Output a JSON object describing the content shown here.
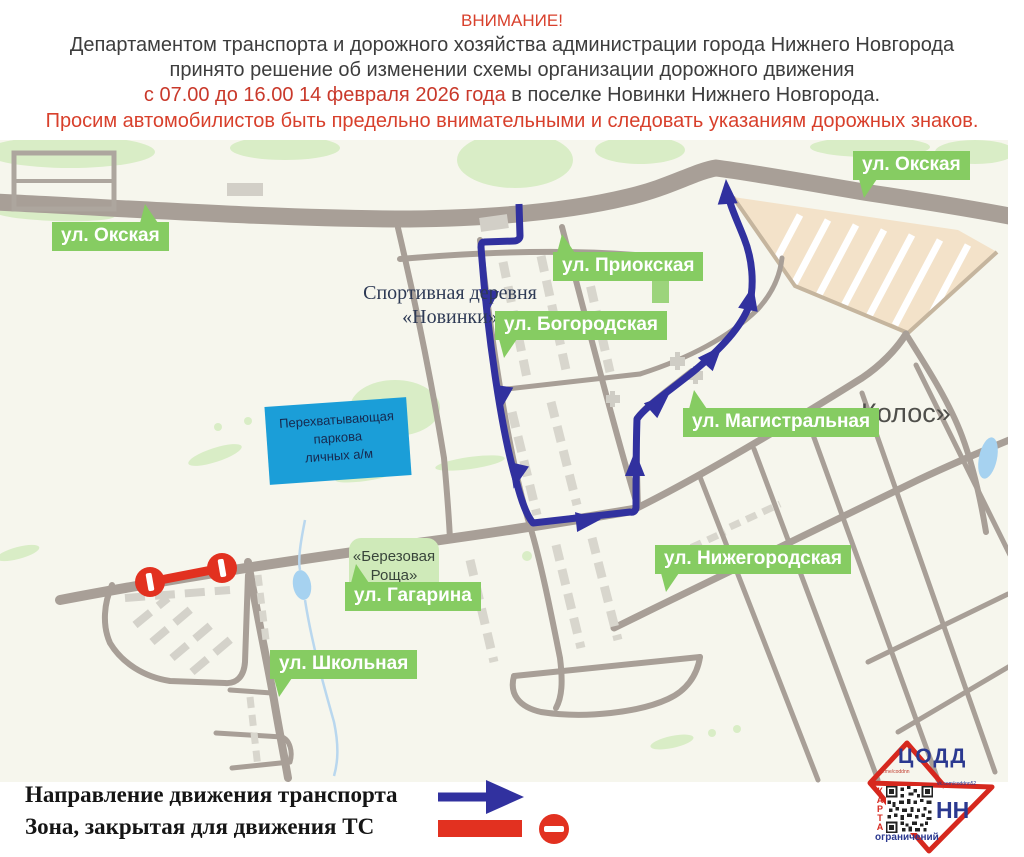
{
  "header": {
    "attention": "ВНИМАНИЕ!",
    "line1": "Департаментом транспорта и дорожного хозяйства администрации города Нижнего Новгорода",
    "line2": "принято решение об изменении схемы организации дорожного движения",
    "line3_red": "с 07.00 до 16.00 14 февраля 2026 года",
    "line3_dark": " в поселке Новинки Нижнего Новгорода.",
    "line4": "Просим автомобилистов быть предельно внимательными и следовать указаниям дорожных знаков."
  },
  "map": {
    "labels": {
      "okskaya_left": "ул. Окская",
      "okskaya_right": "ул. Окская",
      "priokskaya": "ул. Приокская",
      "bogorodskaya": "ул. Богородская",
      "magistralnaya": "ул. Магистральная",
      "nizhegorodskaya": "ул. Нижегородская",
      "gagarina": "ул. Гагарина",
      "shkolnaya": "ул. Школьная"
    },
    "places": {
      "sport_village_line1": "Спортивная деревня",
      "sport_village_line2": "«Новинки»",
      "kolos": "«Колос»",
      "birch_line1": "«Березовая",
      "birch_line2": "Роща»"
    },
    "parking": {
      "line1": "Перехватывающая",
      "line2": "паркова",
      "line3": "личных а/м"
    }
  },
  "legend": {
    "direction_label": "Направление движения транспорта",
    "closed_zone_label": "Зона, закрытая для движения ТС",
    "icons": {
      "direction": "blue-route-arrow",
      "closed_zone": "red-bar-with-no-entry-sign"
    }
  },
  "logo": {
    "org": "ЦОДД",
    "city": "НН",
    "vertical_word": "КАРТА",
    "caption": "ограничений",
    "tg": "t.me/coddnn",
    "vk": "vk.com/coddnn52"
  },
  "colors": {
    "route_blue": "#31319f",
    "closure_red": "#e23120",
    "label_green": "#86cc62",
    "parking_blue": "#1b9ed8",
    "road_gray": "#a89f97",
    "map_background": "#f6f6ed",
    "header_red": "#d8402c",
    "header_dark": "#3d3d3d",
    "logo_blue": "#2b3990",
    "logo_red": "#d6281e",
    "allotment_tan": "#f3e2c9",
    "water_blue": "#a6d2f0",
    "green_area": "#d9edc6"
  }
}
